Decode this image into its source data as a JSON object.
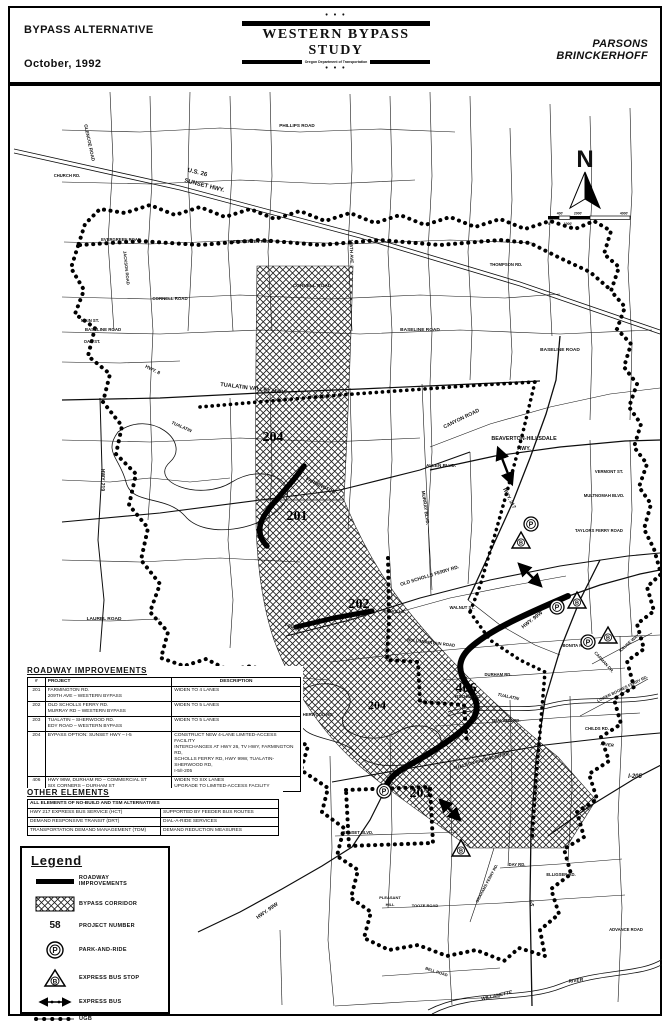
{
  "header": {
    "left_line1": "BYPASS ALTERNATIVE",
    "left_line2": "October, 1992",
    "dots": "• • •",
    "study_title": "WESTERN BYPASS STUDY",
    "study_subtitle": "Oregon Department of Transportation",
    "firm_line1": "PARSONS",
    "firm_line2": "BRINCKERHOFF"
  },
  "compass": {
    "north": "N"
  },
  "scale": {
    "top": [
      "400'",
      "2000'",
      "4000'"
    ],
    "bottom": [
      "0",
      "1000'"
    ]
  },
  "map": {
    "road_labels": [
      "U.S. 26",
      "SUNSET HWY.",
      "PHILLIPS ROAD",
      "GLENCOE ROAD",
      "CHURCH RD.",
      "JACKSON ROAD",
      "EVERGREEN ROAD",
      "EVERGREEN ROAD",
      "CORNELL ROAD",
      "CORNELL ROAD",
      "185TH AVE.",
      "THOMPSON RD.",
      "MAIN ST.",
      "BASELINE ROAD",
      "OAK ST.",
      "BASELINE ROAD",
      "BASELINE ROAD",
      "HWY. 8",
      "TUALATIN VALLEY HWY.",
      "HWY. 219",
      "TUALATIN",
      "FARMINGTON",
      "CANYON ROAD",
      "BEAVERTON-HILLSDALE",
      "HWY.",
      "ALLEN BLVD.",
      "MURRAY BLVD.",
      "HWY. 217",
      "VERMONT ST.",
      "MULTNOMAH BLVD.",
      "TAYLORS FERRY ROAD",
      "OLD SCHOLLS FERRY RD.",
      "SCHOLLS",
      "FERRY",
      "WALNUT ST.",
      "BULL MOUNTAIN ROAD",
      "LAUREL ROAD",
      "SCHOLLS-SHERWOOD RD.",
      "HWY. 99W",
      "DURHAM RD.",
      "FISCHER RD.",
      "TUALATIN",
      "TUALATIN RD.",
      "TUALATIN-SHERWOOD RD.",
      "BONITA ROAD",
      "KRUSE WAY",
      "CARMAN DR.",
      "LOWER BOONES FERRY RD.",
      "CHILDS RD.",
      "RIVER",
      "I-205",
      "I-5",
      "DAY RD.",
      "ELLIGSEN RD.",
      "ADVANCE ROAD",
      "PLEASANT",
      "HILL",
      "TOOZE ROAD",
      "BELL ROAD",
      "GRAHAMS FERRY RD.",
      "HWY. 99W",
      "SUNSET BLVD.",
      "WILLAMETTE",
      "RIVER"
    ],
    "project_labels": [
      "204",
      "201",
      "202",
      "204",
      "406",
      "203"
    ],
    "icons": {
      "park_letter": "P",
      "bus_letter": "B"
    }
  },
  "tables": {
    "roadway": {
      "title": "ROADWAY IMPROVEMENTS",
      "columns": {
        "num": "#",
        "project": "PROJECT",
        "description": "DESCRIPTION"
      },
      "rows": [
        {
          "num": "201",
          "project": "FARMINGTON RD.\n209TH AVE – WESTERN BYPASS",
          "description": "WIDEN TO 4 LANES"
        },
        {
          "num": "202",
          "project": "OLD SCHOLLS FERRY RD.\nMURRAY RD – WESTERN BYPASS",
          "description": "WIDEN TO 5 LANES"
        },
        {
          "num": "203",
          "project": "TUALATIN – SHERWOOD RD.\nEDY ROAD – WESTERN BYPASS",
          "description": "WIDEN TO 5 LANES"
        },
        {
          "num": "204",
          "project": "BYPASS OPTION: SUNSET HWY – I-5",
          "description": "CONSTRUCT NEW 4-LANE LIMITED-ACCESS FACILITY\nINTERCHANGES AT HWY 26, TV HWY, FARMINGTON RD,\nSCHOLLS FERRY RD, HWY 99W, TUALATIN-SHERWOOD RD,\nI-5/I-205"
        },
        {
          "num": "406",
          "project": "HWY 99W, DURHAM RD – COMMERCIAL ST\nSIX CORNERS – DURHAM ST",
          "description": "WIDEN TO SIX LANES\nUPGRADE TO LIMITED-ACCESS FACILITY"
        }
      ]
    },
    "other": {
      "title": "OTHER ELEMENTS",
      "header_row": "ALL ELEMENTS OF NO-BUILD AND TSM ALTERNATIVES",
      "rows": [
        {
          "element": "HWY 217 EXPRESS BUS SERVICE (HCT)",
          "description": "SUPPORTED BY FEEDER BUS ROUTES"
        },
        {
          "element": "DEMAND RESPONSIVE TRANSIT (DRT)",
          "description": "DIAL-A-RIDE SERVICES"
        },
        {
          "element": "TRANSPORTATION DEMAND MANAGEMENT (TDM)",
          "description": "DEMAND REDUCTION MEASURES"
        }
      ]
    }
  },
  "legend": {
    "title": "Legend",
    "items": [
      {
        "label": "ROADWAY IMPROVEMENTS"
      },
      {
        "label": "BYPASS CORRIDOR"
      },
      {
        "label": "PROJECT NUMBER",
        "symbol_text": "58"
      },
      {
        "label": "PARK-AND-RIDE"
      },
      {
        "label": "EXPRESS BUS STOP"
      },
      {
        "label": "EXPRESS BUS"
      },
      {
        "label": "UGB"
      }
    ]
  }
}
